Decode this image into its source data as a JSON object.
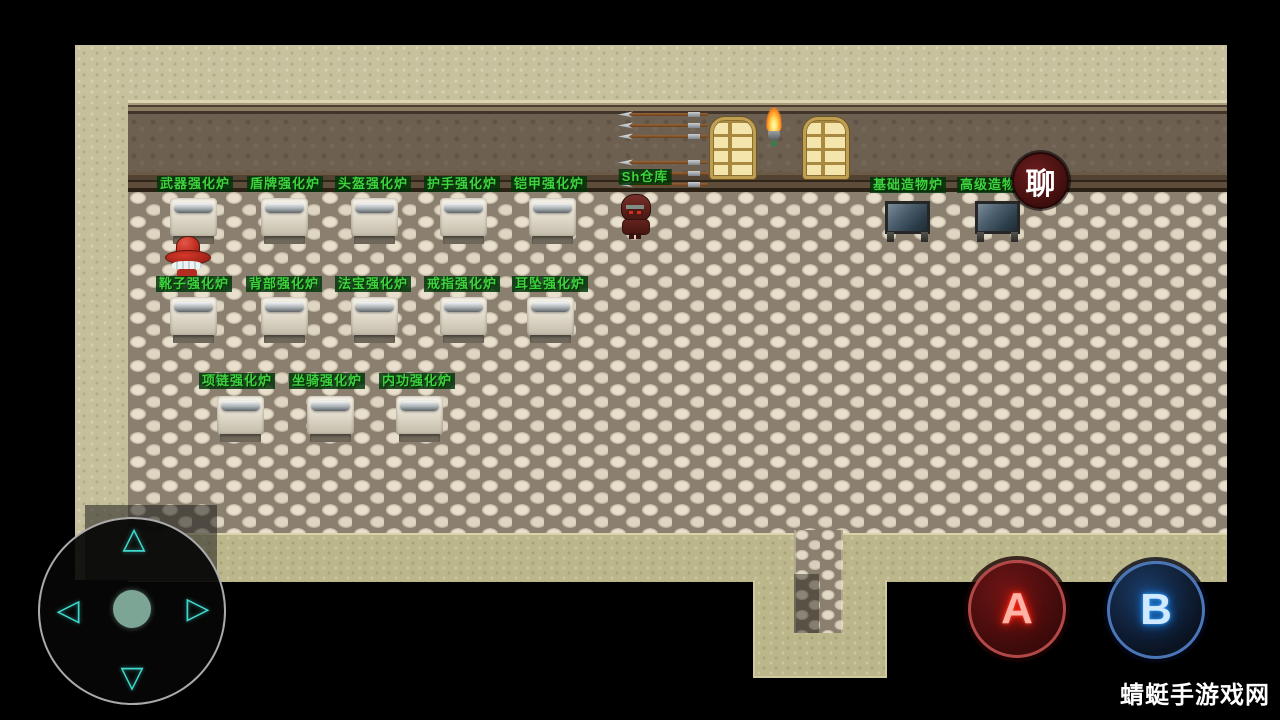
{
  "map": {
    "stations": [
      {
        "label": "武器强化炉"
      },
      {
        "label": "盾牌强化炉"
      },
      {
        "label": "头盔强化炉"
      },
      {
        "label": "护手强化炉"
      },
      {
        "label": "铠甲强化炉"
      },
      {
        "label": "靴子强化炉"
      },
      {
        "label": "背部强化炉"
      },
      {
        "label": "法宝强化炉"
      },
      {
        "label": "戒指强化炉"
      },
      {
        "label": "耳坠强化炉"
      },
      {
        "label": "项链强化炉"
      },
      {
        "label": "坐骑强化炉"
      },
      {
        "label": "内功强化炉"
      }
    ],
    "warehouse_label": "Sh仓库",
    "craft_stations": [
      {
        "label": "基础造物炉"
      },
      {
        "label": "高级造物"
      }
    ]
  },
  "hud": {
    "chat_button_label": "聊",
    "button_a_label": "A",
    "button_b_label": "B",
    "dpad": {
      "up_icon": "△",
      "down_icon": "▽",
      "left_icon": "◁",
      "right_icon": "▷"
    }
  },
  "watermark": "蜻蜓手游戏网",
  "colors": {
    "station_label_text": "#3fd23f",
    "station_label_bg": "#003408",
    "chat_button_bg": "#4a1212",
    "button_a_ring": "#b24848",
    "button_b_ring": "#4a76b8",
    "dpad_accent": "#3fd8cc"
  }
}
